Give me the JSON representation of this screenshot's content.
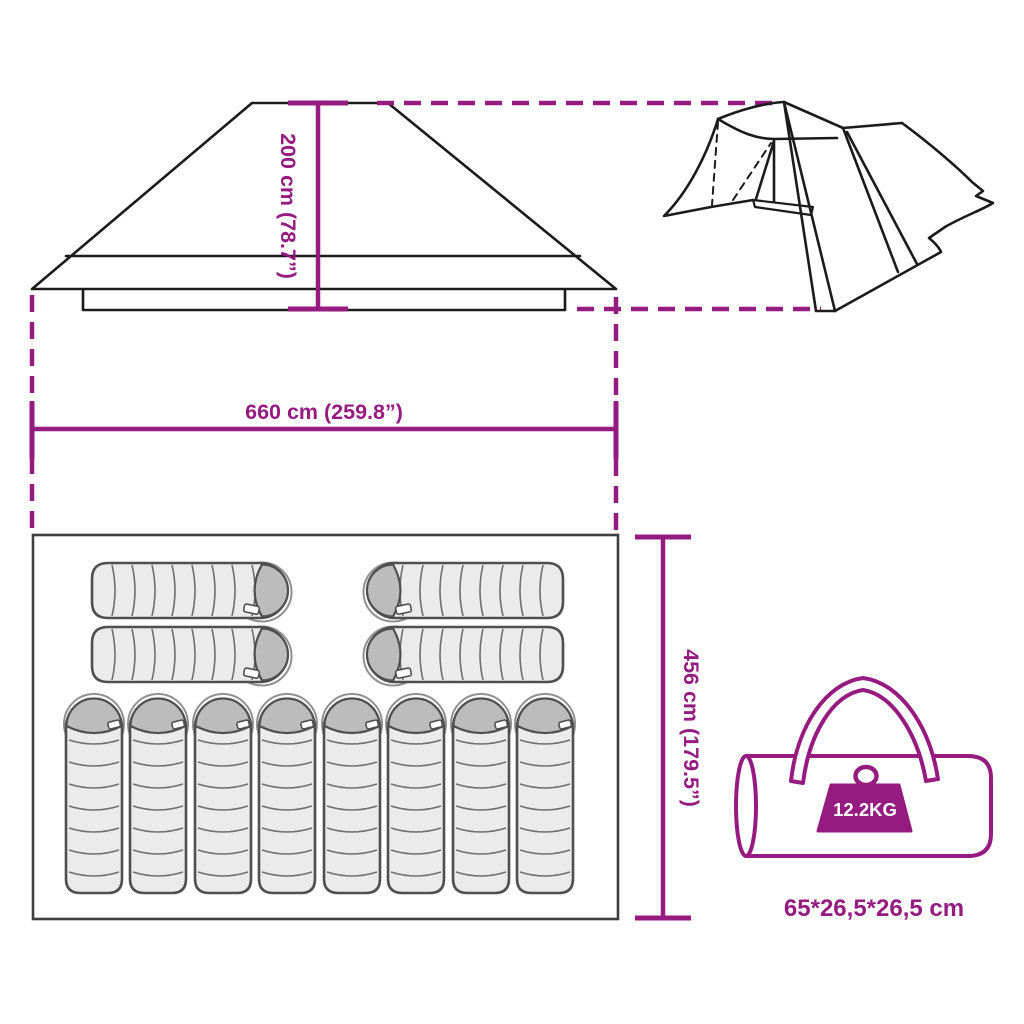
{
  "colors": {
    "accent": "#951B81",
    "ink": "#1B1B1B",
    "bag_fill": "#EBEBEB",
    "bag_hood": "#BCBCBC",
    "bag_outline": "#4F4F4F"
  },
  "labels": {
    "roof_height": "200 cm (78.7”)",
    "width": "660 cm (259.8”)",
    "depth": "456 cm (179.5”)",
    "bag_weight": "12.2KG",
    "bag_size": "65*26,5*26,5 cm"
  },
  "floor_plan": {
    "horizontal_sleeping_bags": 4,
    "vertical_sleeping_bags": 8
  }
}
